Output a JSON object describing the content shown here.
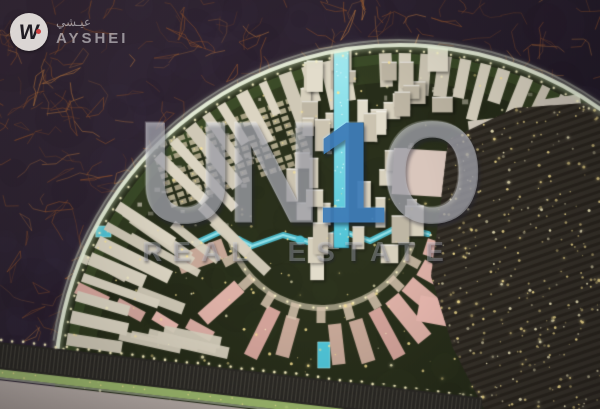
{
  "logo": {
    "icon": "ayshei-monogram-icon",
    "monogram": "W",
    "brand_ar": "عيـشي",
    "brand_en": "AYSHEI"
  },
  "watermark": {
    "prefix": "UN",
    "digit": "1",
    "suffix": "O",
    "subtitle": "REAL ESTATE"
  },
  "scene": {
    "colors": {
      "terrain_base": "#3a2d3c",
      "terrain_shadow": "#1f1826",
      "copper_web": "#9a572f",
      "copper_bright": "#c47f45",
      "dev_green": "#2c321d",
      "dev_green_dark": "#1e2414",
      "hedge_green": "#8fc763",
      "rim_glow": "#eef6e0",
      "building_light": "#dbd4c2",
      "building_mid": "#cfc8b6",
      "villa": "#cfc5a6",
      "pink": "#dba9a0",
      "pink_roof": "#e7b7ae",
      "water": "#4fc3d6",
      "water_light": "#a5ecf2",
      "glow_warm": "#ffe896",
      "glow_bright": "#fff6c8",
      "housing_dark": "#37322a",
      "row_shadow": "#241f18",
      "road": "#948a85",
      "road_light": "#b4aaa5",
      "strip_green": "#a9c776",
      "band_dark": "#2b2925"
    },
    "css": {
      "wm-letter": "rgba(206,208,215,0.45)",
      "wm-blue": "#3f7db8",
      "wm-sub": "rgba(198,203,214,0.32)",
      "logo-fg": "rgba(255,255,255,0.55)",
      "logo-glyph": "#201d24",
      "logo-red": "#d84343"
    }
  }
}
